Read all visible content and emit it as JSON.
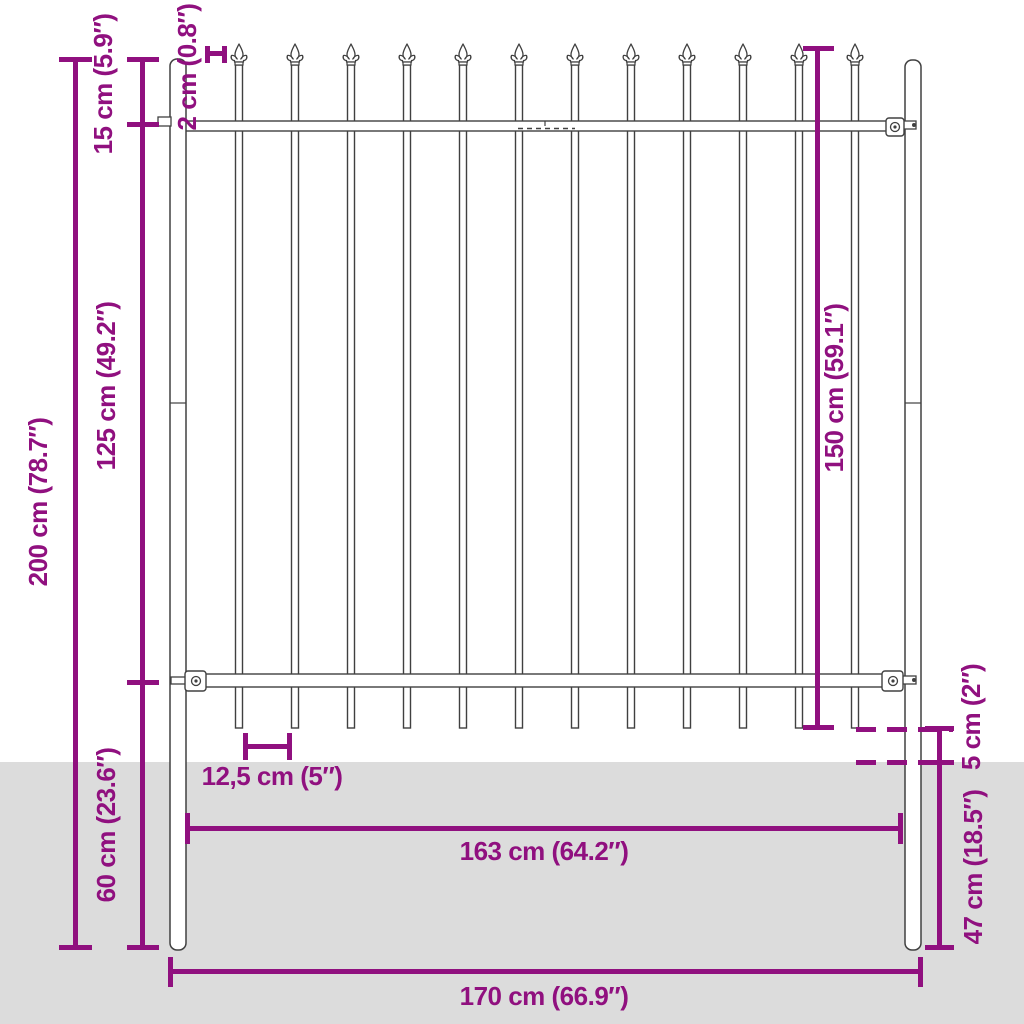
{
  "diagram": {
    "title": "Fence panel with spear top - dimension diagram",
    "colors": {
      "dimension_magenta": "#90107F",
      "ground_gray": "#dcdcdc",
      "line_art": "#404040",
      "background": "#ffffff"
    },
    "structure": {
      "picket_count": 12,
      "post_count": 2,
      "rail_count": 2
    },
    "dimensions": {
      "overall_height": "200 cm (78.7″)",
      "top_offset": "15 cm (5.9″)",
      "mid_section_height": "125 cm (49.2″)",
      "below_ground_height": "60 cm (23.6″)",
      "picket_width": "2 cm (0.8″)",
      "panel_height": "150 cm (59.1″)",
      "picket_spacing": "12,5 cm (5″)",
      "ground_clearance": "5 cm (2″)",
      "post_in_ground": "47 cm (18.5″)",
      "rail_span": "163 cm (64.2″)",
      "overall_width": "170 cm (66.9″)"
    }
  }
}
